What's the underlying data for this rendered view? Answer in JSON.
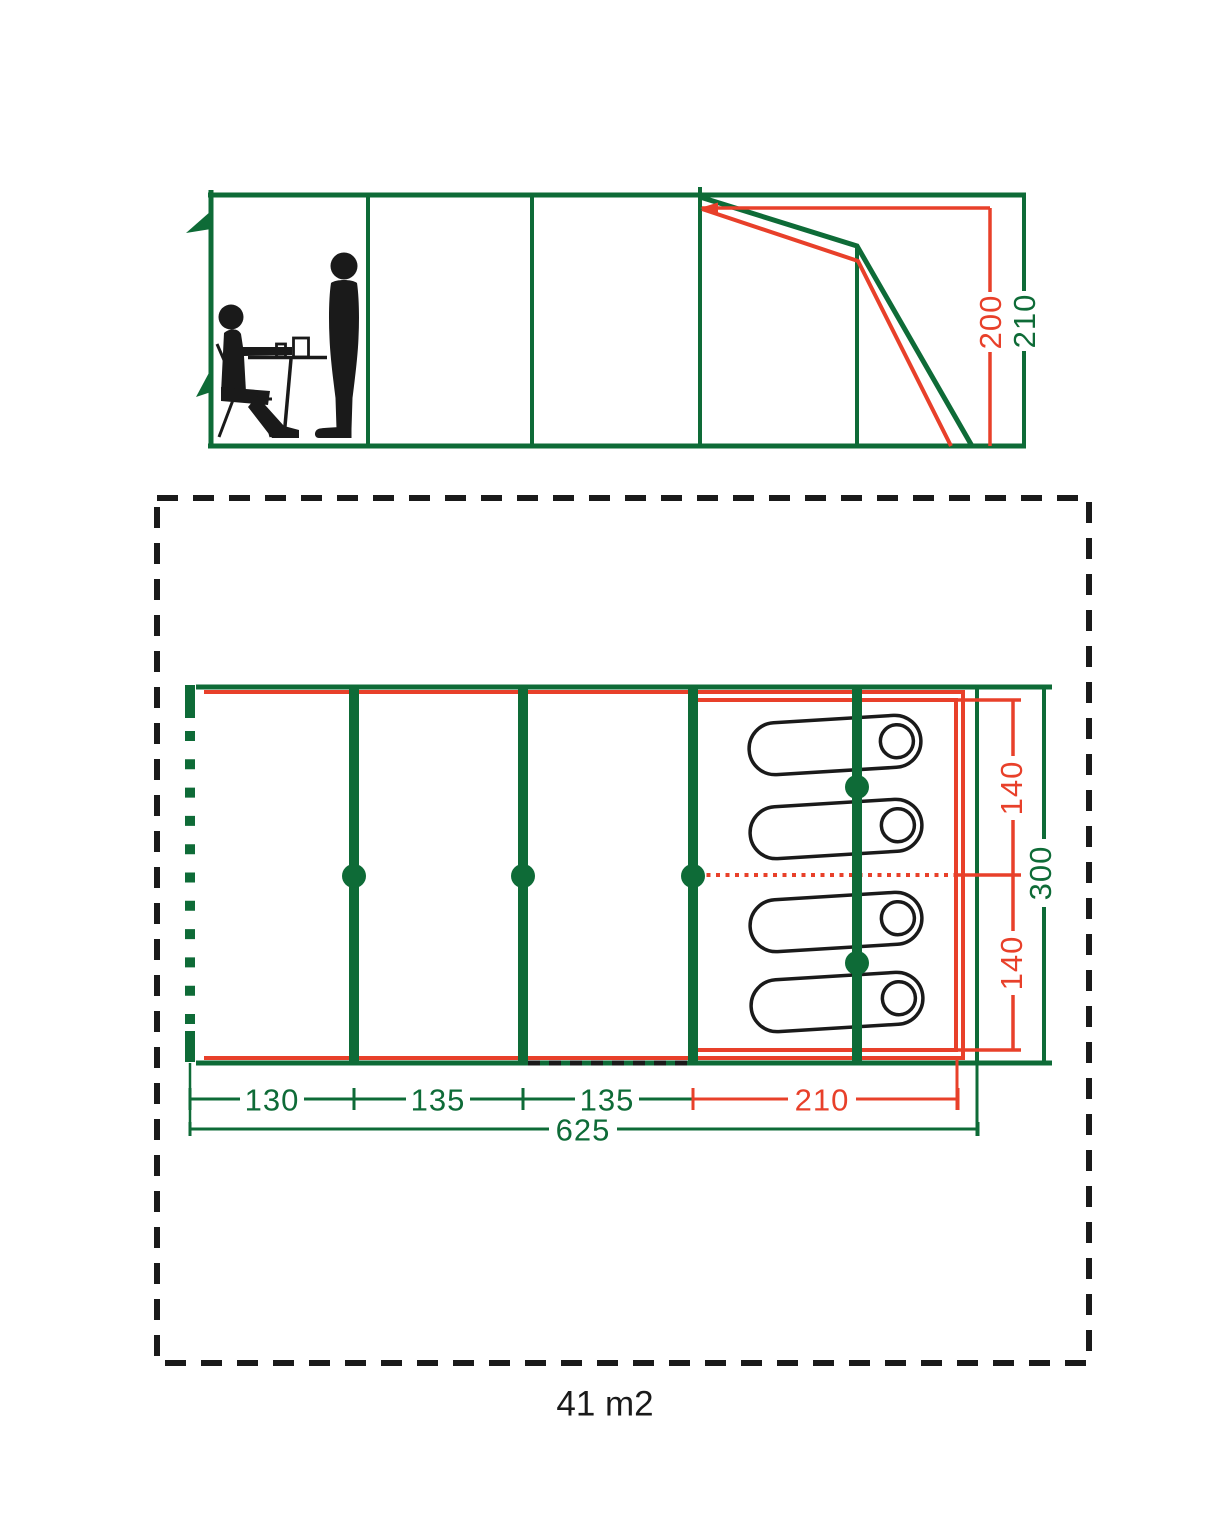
{
  "side_view": {
    "inner_height": "200",
    "outer_height": "210"
  },
  "floor_plan": {
    "section1_width": "130",
    "section2_width": "135",
    "section3_width": "135",
    "bedroom_length": "210",
    "total_length": "625",
    "bedroom_half_top": "140",
    "bedroom_half_bottom": "140",
    "total_width": "300",
    "pitch_area": "41 m2"
  },
  "colors": {
    "green": "#0e6b37",
    "red": "#e8402a",
    "black": "#1a1a1a"
  }
}
